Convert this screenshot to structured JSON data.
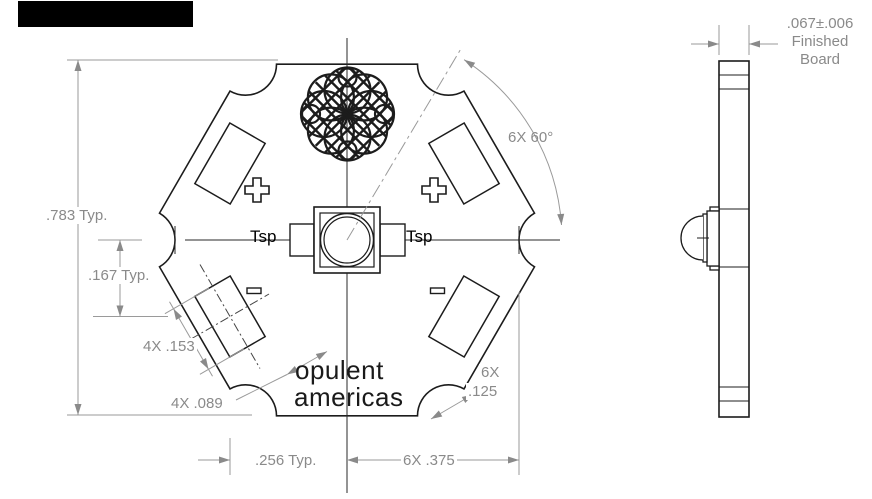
{
  "drawing": {
    "front": {
      "dim_height": ".783 Typ.",
      "dim_offset": ".167 Typ.",
      "dim_pad_length": "4X .153",
      "dim_pad_width": "4X .089",
      "dim_spacing": ".256 Typ.",
      "dim_pitch": "6X .375",
      "dim_notch_line1": "6X",
      "dim_notch_line2": ".125",
      "dim_angle": "6X 60°",
      "label_tsp_left": "Tsp",
      "label_tsp_right": "Tsp",
      "logo_line1": "opulent",
      "logo_line2": "americas"
    },
    "side": {
      "dim_thickness": ".067±.006",
      "label_line2": "Finished",
      "label_line3": "Board"
    }
  },
  "colors": {
    "outline": "#1c1c1c",
    "dimension": "#8a8a8a",
    "background": "#ffffff",
    "redaction": "#000000"
  }
}
